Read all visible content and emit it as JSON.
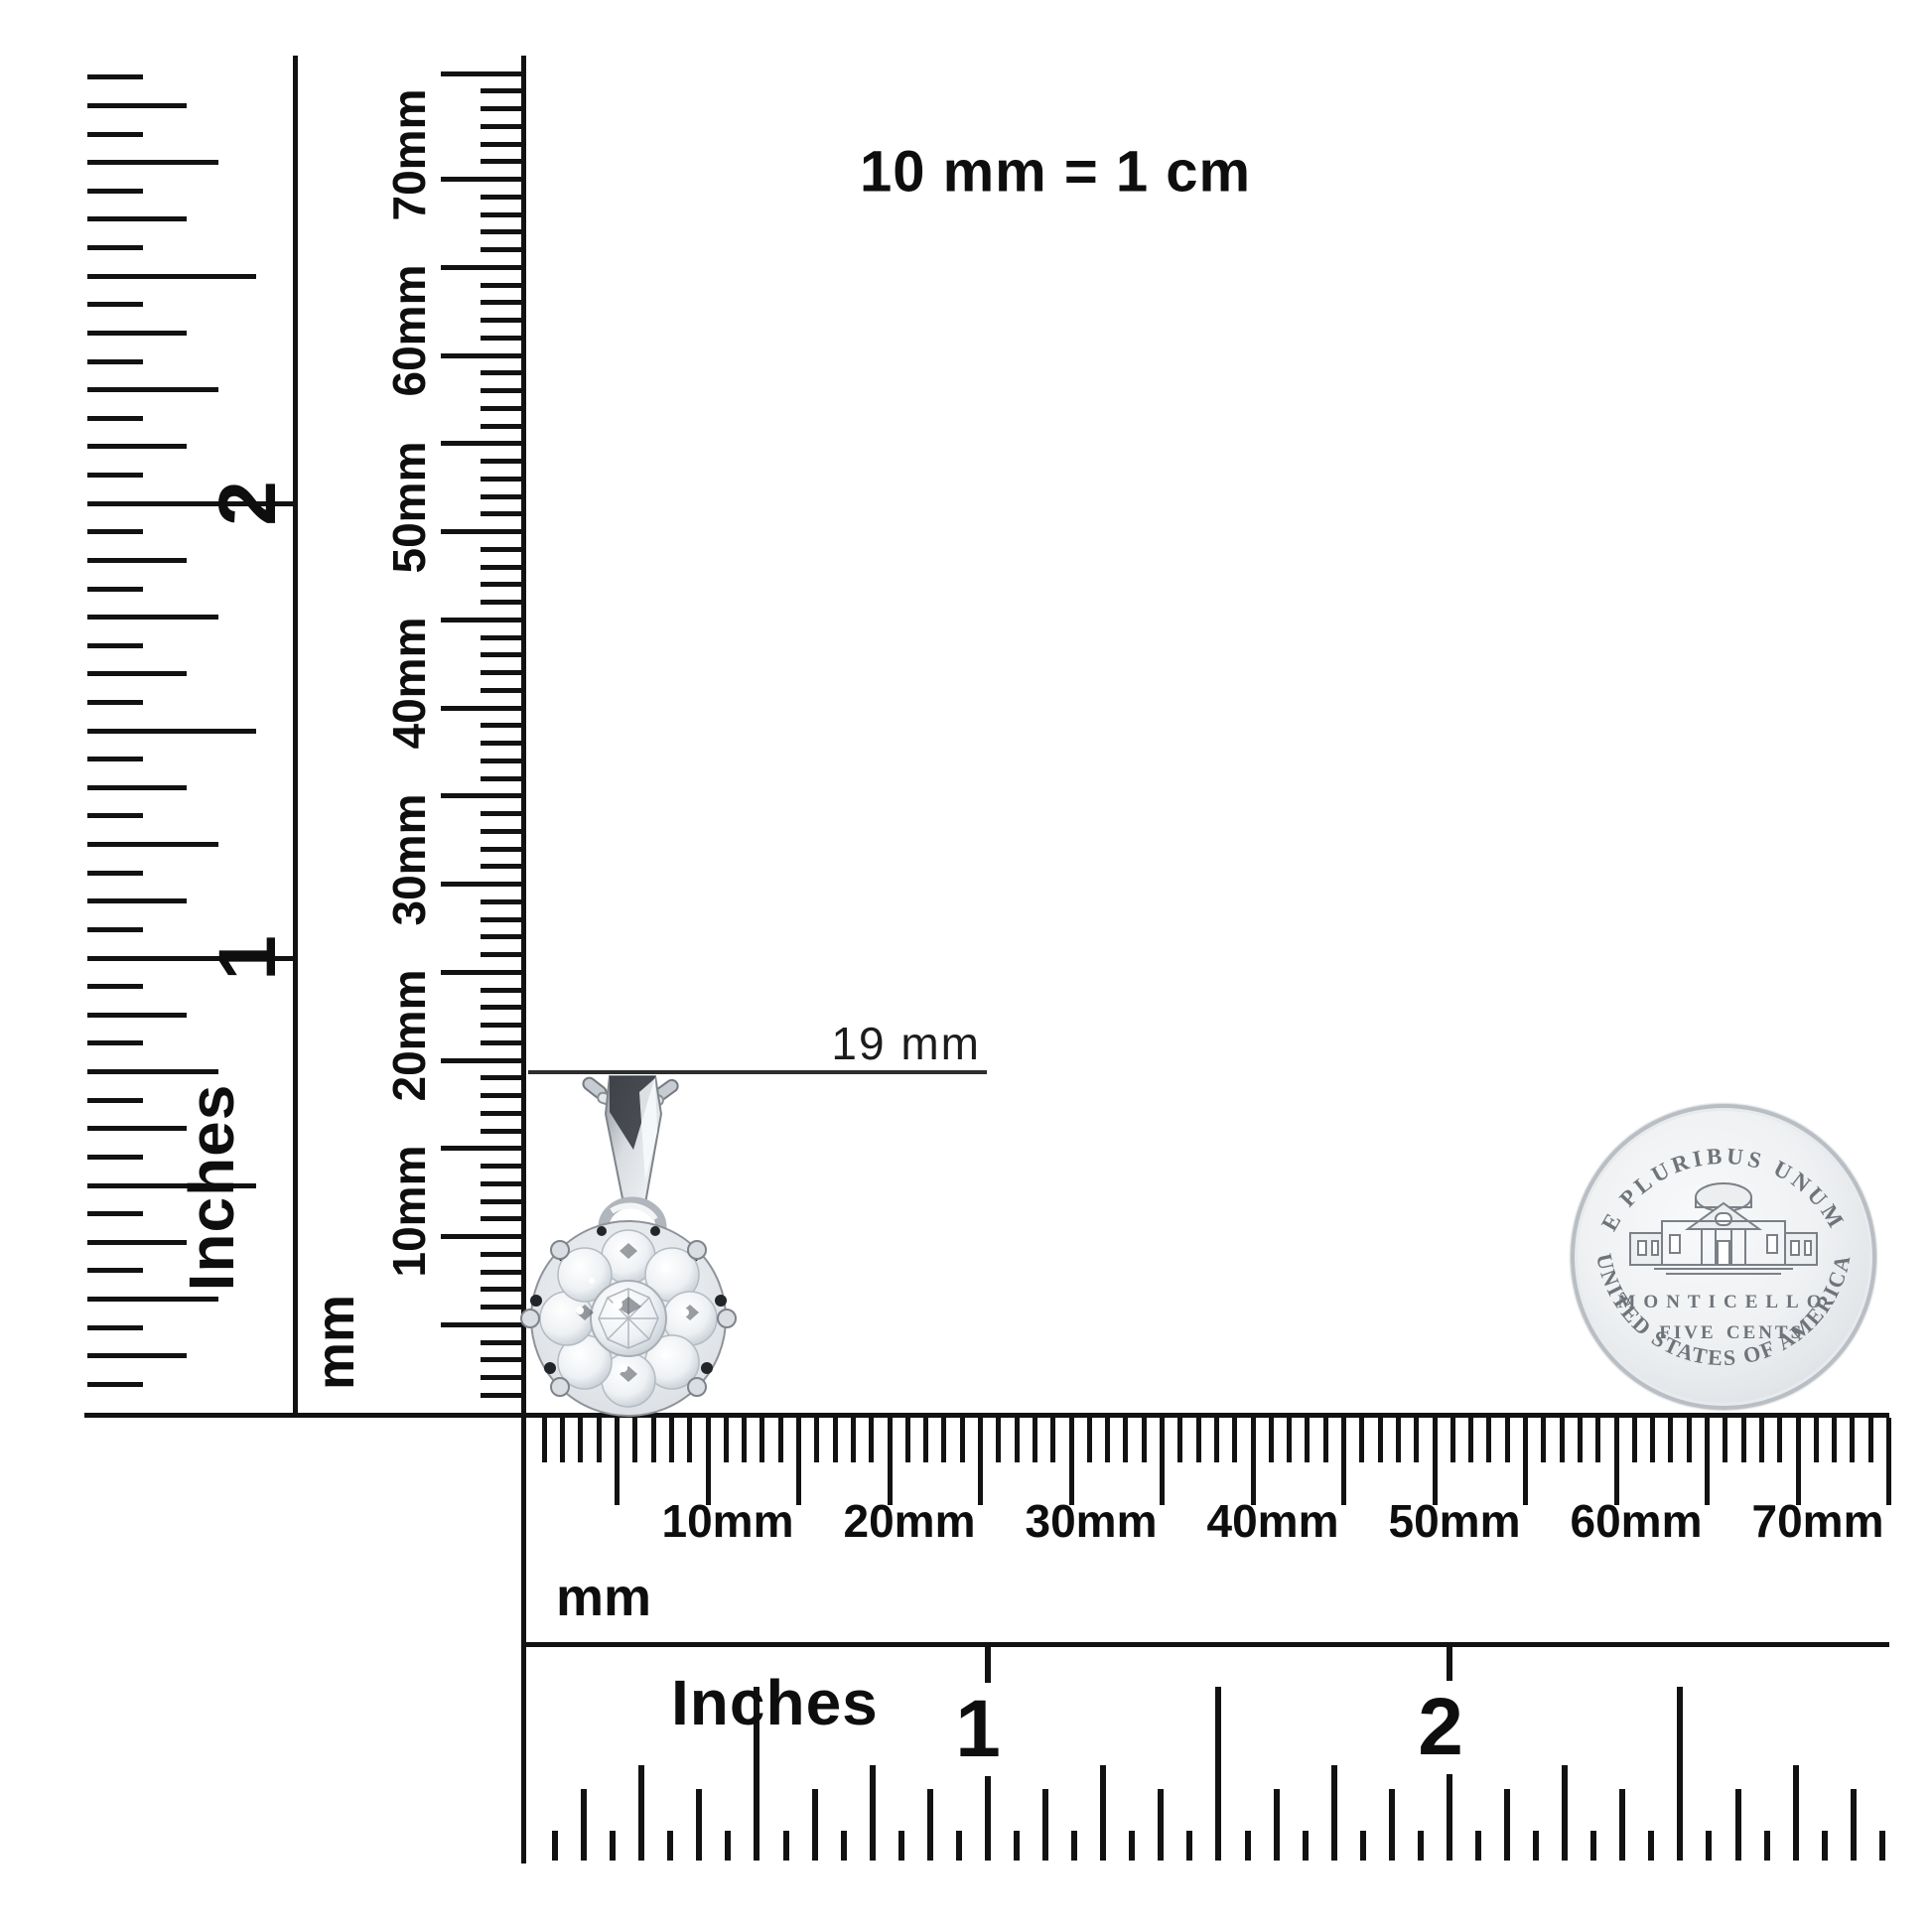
{
  "title": "10 mm = 1 cm",
  "annotation": {
    "label": "19 mm"
  },
  "left_inch_ruler": {
    "unit_label": "Inches",
    "numerals": [
      "1",
      "2"
    ]
  },
  "vertical_mm_ruler": {
    "unit_label": "mm",
    "labels": [
      "10mm",
      "20mm",
      "30mm",
      "40mm",
      "50mm",
      "60mm",
      "70mm"
    ]
  },
  "horizontal_mm_ruler": {
    "unit_label": "mm",
    "labels": [
      "10mm",
      "20mm",
      "30mm",
      "40mm",
      "50mm",
      "60mm",
      "70mm"
    ]
  },
  "horizontal_inch_ruler": {
    "unit_label": "Inches",
    "numerals": [
      "1",
      "2"
    ]
  },
  "coin": {
    "top_text": "E PLURIBUS UNUM",
    "building_label": "MONTICELLO",
    "denom_word1": "FIVE",
    "denom_word2": "CENTS",
    "bottom_text": "UNITED STATES OF AMERICA"
  },
  "colors": {
    "ink": "#121212",
    "silver": "#d7dade",
    "coin_text": "#6e747a",
    "background": "#ffffff"
  }
}
